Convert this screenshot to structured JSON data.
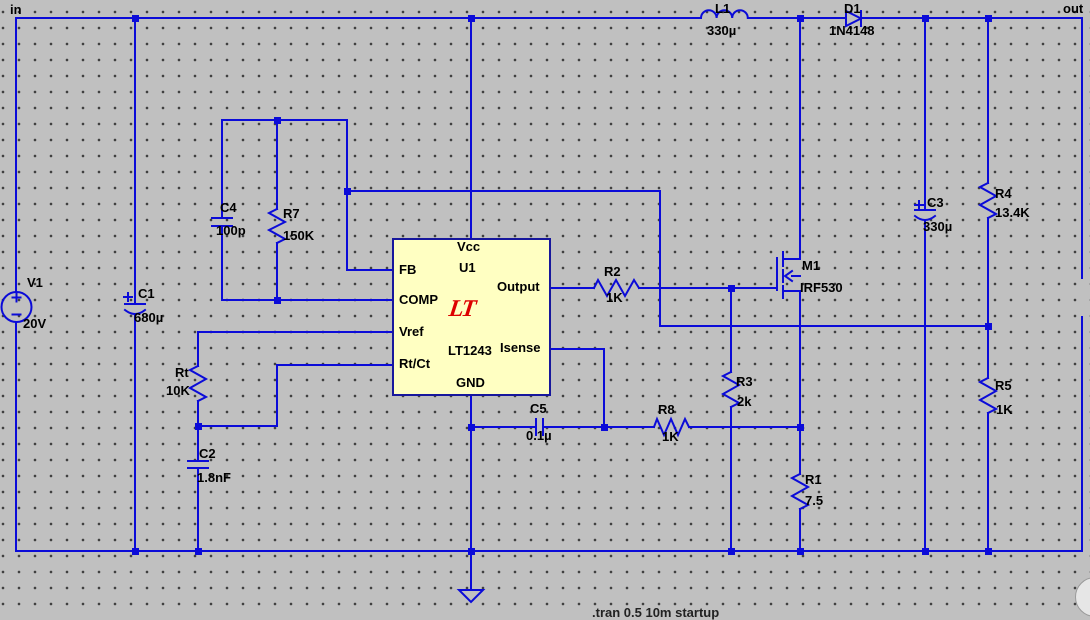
{
  "window": {
    "width": 1090,
    "height": 612,
    "background": "#c0c0c0"
  },
  "colors": {
    "wire": "#0b0bd8",
    "ic_border": "#17179c",
    "ic_fill": "#ffffc2",
    "logo_red": "#dd0000",
    "text": "#000000",
    "grid_dot": "#3c3c3c"
  },
  "net_labels": {
    "input": "in",
    "output": "out"
  },
  "ic": {
    "refdes": "U1",
    "part": "LT1243",
    "logo_text": "LT",
    "pins": {
      "vcc": "Vcc",
      "fb": "FB",
      "comp": "COMP",
      "vref": "Vref",
      "rtct": "Rt/Ct",
      "output": "Output",
      "isense": "Isense",
      "gnd": "GND"
    }
  },
  "components": {
    "v1": {
      "name": "V1",
      "value": "20V"
    },
    "c1": {
      "name": "C1",
      "value": "680µ"
    },
    "c2": {
      "name": "C2",
      "value": "1.8nF"
    },
    "c3": {
      "name": "C3",
      "value": "330µ"
    },
    "c4": {
      "name": "C4",
      "value": "100p"
    },
    "c5": {
      "name": "C5",
      "value": "0.1µ"
    },
    "rt": {
      "name": "Rt",
      "value": "10K"
    },
    "r1": {
      "name": "R1",
      "value": "7.5"
    },
    "r2": {
      "name": "R2",
      "value": "1K"
    },
    "r3": {
      "name": "R3",
      "value": "2k"
    },
    "r4": {
      "name": "R4",
      "value": "13.4K"
    },
    "r5": {
      "name": "R5",
      "value": "1K"
    },
    "r7": {
      "name": "R7",
      "value": "150K"
    },
    "r8": {
      "name": "R8",
      "value": "1K"
    },
    "l1": {
      "name": "L1",
      "value": "330µ"
    },
    "d1": {
      "name": "D1",
      "value": "1N4148"
    },
    "m1": {
      "name": "M1",
      "value": "IRF530"
    }
  },
  "partial_directive": ".tran 0.5 10m startup"
}
